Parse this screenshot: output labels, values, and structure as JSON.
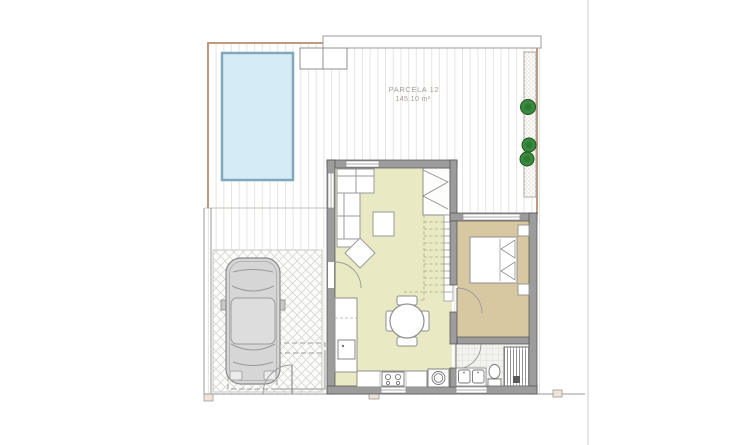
{
  "plan": {
    "parcel_label": "PARCELA 12",
    "parcel_area": "145.10 m²"
  },
  "features": {
    "pool": "swimming-pool",
    "car": "car-top-view",
    "plants_count": 3,
    "rooms": [
      "terrace",
      "living-dining",
      "kitchen",
      "bedroom",
      "bathroom",
      "garage",
      "stairs"
    ],
    "fixtures": [
      "sofa",
      "coffee-table",
      "side-table",
      "dining-table",
      "fridge",
      "stove",
      "washing-machine",
      "double-sink-vanity",
      "toilet",
      "shower",
      "bed",
      "nightstands"
    ]
  },
  "colors": {
    "pool_fill": "#d5ecf7",
    "pool_border": "#7fa8bd",
    "living_floor": "#e9e9c3",
    "bedroom_floor": "#d8c8a2",
    "wall_gray": "#9c9c9c",
    "boundary_tan": "#c0997e",
    "plant_green": "#2d7a33",
    "car_body": "#d6d6d6",
    "label_gray": "#a39d98"
  }
}
